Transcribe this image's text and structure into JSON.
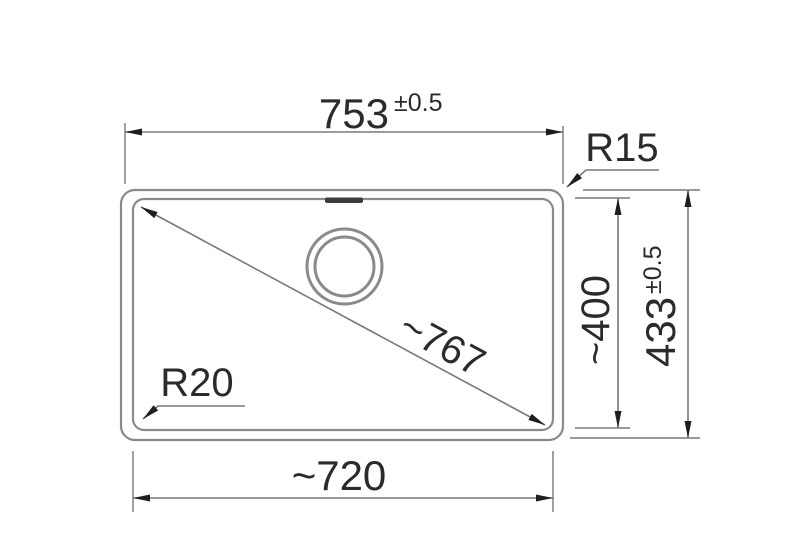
{
  "drawing": {
    "type": "technical-dimension-drawing",
    "subject": "rectangular sink bowl with drain, dimensioned",
    "colors": {
      "bg": "#ffffff",
      "geometry_line": "#8a8a8a",
      "dimension_line": "#787878",
      "arrow": "#1e1e1e",
      "text": "#2b2b2b",
      "slot_fill": "#3c3c3c"
    },
    "dims": {
      "overall_width": {
        "value": "753",
        "tolerance": "±0.5"
      },
      "overall_height": {
        "value": "433",
        "tolerance": "±0.5"
      },
      "bowl_width": {
        "value": "~720"
      },
      "bowl_height": {
        "value": "~400"
      },
      "diagonal": {
        "value": "~767"
      },
      "radius_outer": {
        "value": "R15"
      },
      "radius_inner": {
        "value": "R20"
      }
    }
  }
}
